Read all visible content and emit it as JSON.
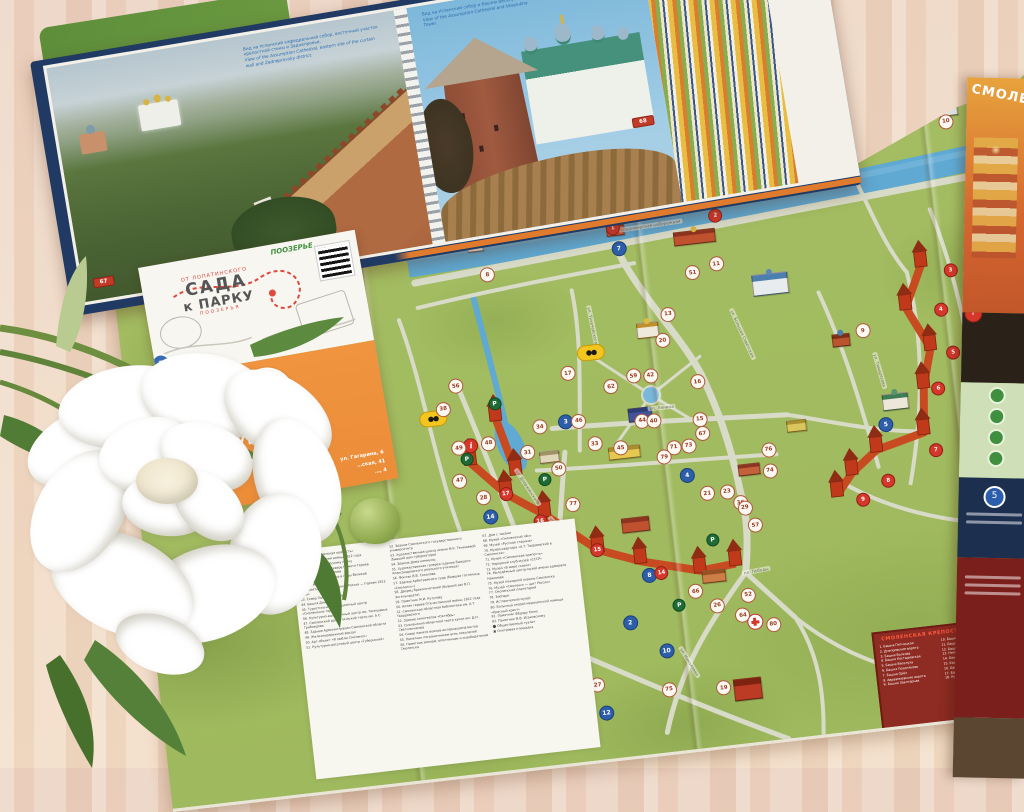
{
  "book": {
    "left_page": {
      "caption_ru": "Вид на Успенский кафедральный собор, восточный участок крепостной стены и Заднепровье.",
      "caption_en": "View of the Assumption Cathedral, eastern site of the curtain wall and Zadneprovsky district.",
      "page_number": "67"
    },
    "right_page": {
      "caption_ru": "Вид на Успенский собор и башню Веселуха.",
      "caption_en": "View of the Assumption Cathedral and Veselukha Tower.",
      "page_number": "68"
    }
  },
  "leaflet": {
    "header_small": "ОТ ЛОПАТИНСКОГО",
    "title_line1": "САДА",
    "title_line2": "к ПАРКУ",
    "subtitle": "ПООЗЕРЬЯ",
    "corner_text": "ПООЗЕРЬЕ",
    "badge": "3",
    "logo_text": "ФЫР-ФЫР",
    "shop_line1": "…ЫЕ СУВЕНИРЫ",
    "shop_line2": "СМОЛЕНСКА",
    "addresses": [
      "ул. Гагарина, 6",
      "…ская, 41",
      "…, 4"
    ]
  },
  "map": {
    "cover_title": "СМОЛЕНСК",
    "cover_badge": "5",
    "info_symbol": "i",
    "river_label": "Владимирская набережная",
    "streets": [
      {
        "label": "Владимирская набережная",
        "x": 54,
        "y": 17.5,
        "r": -2
      },
      {
        "label": "ул. Большая Советская",
        "x": 63,
        "y": 36,
        "r": 72
      },
      {
        "label": "ул. Ленина",
        "x": 55,
        "y": 46,
        "r": 1
      },
      {
        "label": "ул. Дзержинского",
        "x": 39,
        "y": 56,
        "r": 63
      },
      {
        "label": "ул. Тухачевского",
        "x": 48,
        "y": 32,
        "r": 85
      },
      {
        "label": "пл. Победы",
        "x": 63,
        "y": 73,
        "r": -4
      },
      {
        "label": "ул. Николаева",
        "x": 54.5,
        "y": 86,
        "r": 65
      },
      {
        "label": "ул. Тимирязева",
        "x": 78,
        "y": 44,
        "r": 80
      },
      {
        "label": "ул. Гагарина",
        "x": 42.5,
        "y": 63,
        "r": 55
      }
    ],
    "markers": [
      {
        "x": 39.7,
        "y": 22.7,
        "type": "w",
        "label": "8"
      },
      {
        "x": 53.9,
        "y": 20.9,
        "type": "b",
        "label": "7"
      },
      {
        "x": 64.0,
        "y": 25.0,
        "type": "w",
        "label": "11"
      },
      {
        "x": 61.4,
        "y": 26.0,
        "type": "w",
        "label": "51"
      },
      {
        "x": 78.7,
        "y": 38.0,
        "type": "w",
        "label": "9"
      },
      {
        "x": 90.0,
        "y": 7.0,
        "type": "w",
        "label": "10"
      },
      {
        "x": 58.3,
        "y": 32.0,
        "type": "w",
        "label": "13"
      },
      {
        "x": 57.4,
        "y": 36.0,
        "type": "w",
        "label": "20"
      },
      {
        "x": 47.0,
        "y": 39.4,
        "type": "w",
        "label": "17"
      },
      {
        "x": 49.7,
        "y": 36.6,
        "type": "v",
        "label": "●●"
      },
      {
        "x": 32.2,
        "y": 44.0,
        "type": "v",
        "label": "●●"
      },
      {
        "x": 35.0,
        "y": 39.4,
        "type": "w",
        "label": "56"
      },
      {
        "x": 33.4,
        "y": 42.8,
        "type": "w",
        "label": "38"
      },
      {
        "x": 35.9,
        "y": 48.9,
        "type": "i",
        "label": "i"
      },
      {
        "x": 34.6,
        "y": 49.1,
        "type": "w",
        "label": "49"
      },
      {
        "x": 37.8,
        "y": 48.9,
        "type": "w",
        "label": "48"
      },
      {
        "x": 34.3,
        "y": 54.2,
        "type": "w",
        "label": "47"
      },
      {
        "x": 36.6,
        "y": 57.2,
        "type": "w",
        "label": "28"
      },
      {
        "x": 46.2,
        "y": 46.9,
        "type": "b",
        "label": "3"
      },
      {
        "x": 47.6,
        "y": 47.0,
        "type": "w",
        "label": "46"
      },
      {
        "x": 43.4,
        "y": 47.2,
        "type": "w",
        "label": "34"
      },
      {
        "x": 41.8,
        "y": 51.0,
        "type": "w",
        "label": "31"
      },
      {
        "x": 44.9,
        "y": 54.0,
        "type": "w",
        "label": "50"
      },
      {
        "x": 53.9,
        "y": 41.0,
        "type": "w",
        "label": "59"
      },
      {
        "x": 55.7,
        "y": 41.2,
        "type": "w",
        "label": "42"
      },
      {
        "x": 60.6,
        "y": 43.0,
        "type": "w",
        "label": "16"
      },
      {
        "x": 51.4,
        "y": 42.2,
        "type": "w",
        "label": "62"
      },
      {
        "x": 60.4,
        "y": 48.9,
        "type": "w",
        "label": "15"
      },
      {
        "x": 60.5,
        "y": 51.1,
        "type": "w",
        "label": "67"
      },
      {
        "x": 49.0,
        "y": 50.8,
        "type": "w",
        "label": "33"
      },
      {
        "x": 51.7,
        "y": 51.9,
        "type": "w",
        "label": "45"
      },
      {
        "x": 54.3,
        "y": 48.1,
        "type": "w",
        "label": "44"
      },
      {
        "x": 55.5,
        "y": 48.3,
        "type": "w",
        "label": "40"
      },
      {
        "x": 57.3,
        "y": 52.8,
        "type": "w",
        "label": "71"
      },
      {
        "x": 58.9,
        "y": 52.8,
        "type": "w",
        "label": "73"
      },
      {
        "x": 56.2,
        "y": 54.1,
        "type": "w",
        "label": "79"
      },
      {
        "x": 63.8,
        "y": 81.3,
        "type": "x",
        "label": ""
      },
      {
        "x": 65.0,
        "y": 66.3,
        "type": "w",
        "label": "57"
      },
      {
        "x": 63.7,
        "y": 62.5,
        "type": "w",
        "label": "36"
      },
      {
        "x": 62.4,
        "y": 60.6,
        "type": "w",
        "label": "23"
      },
      {
        "x": 64.1,
        "y": 63.4,
        "type": "w",
        "label": "29"
      },
      {
        "x": 60.3,
        "y": 60.5,
        "type": "w",
        "label": "21"
      },
      {
        "x": 67.2,
        "y": 58.1,
        "type": "w",
        "label": "74"
      },
      {
        "x": 67.3,
        "y": 54.8,
        "type": "w",
        "label": "76"
      },
      {
        "x": 57.9,
        "y": 75.5,
        "type": "w",
        "label": "66"
      },
      {
        "x": 60.0,
        "y": 78.1,
        "type": "w",
        "label": "26"
      },
      {
        "x": 63.4,
        "y": 77.0,
        "type": "w",
        "label": "52"
      },
      {
        "x": 62.6,
        "y": 80.0,
        "type": "w",
        "label": "64"
      },
      {
        "x": 65.7,
        "y": 82.0,
        "type": "w",
        "label": "80"
      },
      {
        "x": 53.9,
        "y": 90.3,
        "type": "w",
        "label": "75"
      },
      {
        "x": 59.7,
        "y": 91.0,
        "type": "w",
        "label": "19"
      },
      {
        "x": 46.4,
        "y": 88.3,
        "type": "w",
        "label": "27"
      },
      {
        "x": 39.1,
        "y": 64.7,
        "type": "w",
        "label": "37"
      },
      {
        "x": 44.5,
        "y": 66.0,
        "type": "w",
        "label": "35"
      },
      {
        "x": 42.6,
        "y": 67.8,
        "type": "w",
        "label": "63"
      },
      {
        "x": 46.0,
        "y": 59.8,
        "type": "w",
        "label": "77"
      },
      {
        "x": 53.2,
        "y": 72.2,
        "type": "b",
        "label": "8"
      },
      {
        "x": 50.6,
        "y": 79.2,
        "type": "b",
        "label": "2"
      },
      {
        "x": 54.1,
        "y": 84.2,
        "type": "b",
        "label": "10"
      },
      {
        "x": 47.0,
        "y": 92.8,
        "type": "b",
        "label": "12"
      },
      {
        "x": 37.1,
        "y": 60.3,
        "type": "b",
        "label": "14"
      },
      {
        "x": 58.4,
        "y": 57.3,
        "type": "b",
        "label": "4"
      },
      {
        "x": 80.0,
        "y": 53.0,
        "type": "b",
        "label": "5"
      },
      {
        "x": 88.7,
        "y": 30.2,
        "type": "r",
        "label": "3"
      },
      {
        "x": 87.2,
        "y": 36.1,
        "type": "r",
        "label": "4"
      },
      {
        "x": 88.0,
        "y": 43.0,
        "type": "r",
        "label": "5"
      },
      {
        "x": 86.0,
        "y": 48.3,
        "type": "r",
        "label": "6"
      },
      {
        "x": 85.0,
        "y": 57.8,
        "type": "r",
        "label": "7"
      },
      {
        "x": 79.6,
        "y": 61.7,
        "type": "r",
        "label": "8"
      },
      {
        "x": 76.7,
        "y": 64.2,
        "type": "r",
        "label": "9"
      },
      {
        "x": 39.0,
        "y": 57.0,
        "type": "r",
        "label": "17"
      },
      {
        "x": 42.3,
        "y": 61.9,
        "type": "r",
        "label": "16"
      },
      {
        "x": 48.0,
        "y": 67.4,
        "type": "r",
        "label": "15"
      },
      {
        "x": 54.5,
        "y": 72.0,
        "type": "r",
        "label": "14"
      },
      {
        "x": 53.5,
        "y": 17.7,
        "type": "r",
        "label": "1"
      },
      {
        "x": 64.5,
        "y": 17.5,
        "type": "r",
        "label": "2"
      },
      {
        "x": 43.3,
        "y": 55.5,
        "type": "p",
        "label": "P"
      },
      {
        "x": 60.3,
        "y": 67.8,
        "type": "p",
        "label": "P"
      },
      {
        "x": 56.0,
        "y": 77.3,
        "type": "p",
        "label": "P"
      },
      {
        "x": 38.9,
        "y": 42.8,
        "type": "p",
        "label": "P"
      },
      {
        "x": 35.3,
        "y": 51.0,
        "type": "p",
        "label": "P"
      }
    ],
    "buildings": [
      {
        "x": 69.5,
        "y": 29.0,
        "w": 34,
        "h": 20,
        "body": "#e9ecef",
        "roof": "#4c7fae",
        "dome": "#5c88b4"
      },
      {
        "x": 90.0,
        "y": 5.0,
        "w": 24,
        "h": 13,
        "body": "#dfe3de",
        "roof": "#6a8d57",
        "dome": "#88a46a"
      },
      {
        "x": 53.7,
        "y": 17.8,
        "w": 16,
        "h": 12,
        "body": "#c8553a",
        "roof": "#8d3420",
        "dome": "#d8b341"
      },
      {
        "x": 62.0,
        "y": 20.5,
        "w": 40,
        "h": 12,
        "body": "#c0512f",
        "roof": "#8d3420",
        "dome": "#d8b341"
      },
      {
        "x": 38.7,
        "y": 18.0,
        "w": 14,
        "h": 10,
        "body": "#f0eee6",
        "roof": "#8a8f93",
        "dome": null
      },
      {
        "x": 56.0,
        "y": 34.0,
        "w": 20,
        "h": 14,
        "body": "#efe9db",
        "roof": "#bf8f2c",
        "dome": "#e2b93b"
      },
      {
        "x": 54.1,
        "y": 47.0,
        "w": 22,
        "h": 12,
        "body": "#40549c",
        "roof": "#2c3c74",
        "dome": null
      },
      {
        "x": 52.0,
        "y": 52.6,
        "w": 30,
        "h": 11,
        "body": "#e5c84f",
        "roof": "#a98f2d",
        "dome": null
      },
      {
        "x": 52.3,
        "y": 64.0,
        "w": 26,
        "h": 13,
        "body": "#c0512f",
        "roof": "#8d3420",
        "dome": null
      },
      {
        "x": 81.3,
        "y": 49.5,
        "w": 24,
        "h": 15,
        "body": "#ece7d8",
        "roof": "#3f7d57",
        "dome": "#56946b"
      },
      {
        "x": 76.3,
        "y": 39.0,
        "w": 16,
        "h": 11,
        "body": "#b9542f",
        "roof": "#7e2d18",
        "dome": "#4c7fae"
      },
      {
        "x": 62.2,
        "y": 91.5,
        "w": 26,
        "h": 20,
        "body": "#bb3b24",
        "roof": "#7e2212",
        "dome": null
      },
      {
        "x": 65.0,
        "y": 57.5,
        "w": 20,
        "h": 10,
        "body": "#c4603a",
        "roof": "#8d3420",
        "dome": null
      },
      {
        "x": 60.0,
        "y": 73.5,
        "w": 22,
        "h": 11,
        "body": "#cd7d46",
        "roof": "#95511f",
        "dome": null
      },
      {
        "x": 44.0,
        "y": 52.0,
        "w": 18,
        "h": 10,
        "body": "#e0d6b8",
        "roof": "#a09264",
        "dome": null
      },
      {
        "x": 70.5,
        "y": 51.5,
        "w": 18,
        "h": 10,
        "body": "#d9c75e",
        "roof": "#a98f2d",
        "dome": null
      }
    ],
    "legend": {
      "columns": [
        [
          "36. Музей «Смоленская крепость»",
          "37. Памятник Героям войны 1812 года",
          "38. Памятник Софийскому полку",
          "39. Вечный огонь в Сквере Памяти Героев",
          "40. Аллея городов-героев",
          "41. Музей «Смоленщина в годы Великой Отечественной войны»",
          "42. Памятник «Благодарная Россия — Героям 1812 года»",
          "43. Сквер Памяти Героев",
          "44. Башня Донец",
          "45. Туристско-информационный центр «Смоленские терема»",
          "46. Культурно-выставочный центр им. Тенишевых",
          "47. Смоленский драматический театр им. А.С. Грибоедова",
          "48. Здание Администрации Смоленской области",
          "49. Железнодорожный вокзал",
          "50. Арт-объект «Я люблю Смоленск»",
          "51. Культурно-досуговый центр «Губернский»"
        ],
        [
          "52. Здание Смоленского государственного университета",
          "53. Художественная школа имени М.К. Тенишевой (бывший дом губернатора)",
          "54. Здание Дома-коммуны",
          "55. Художественная галерея (здание бывшего Александровского реального училища)",
          "56. Фонтан В.В. Соколова",
          "57. Здание Арбитражного суда (бывшая гостиница «Смоленск»)",
          "58. Дворец бракосочетаний (бывший зал В.П. Энгельгардта)",
          "59. Памятник М.И. Кутузову",
          "60. Аллея героев Отечественной войны 1812 года",
          "61. Смоленская областная библиотека им. А.Т. Твардовского",
          "62. Здание кинотеатра «Октябрь»",
          "63. Смоленский областной театр кукол им. Д.Н. Светильникова",
          "64. Сквер памяти воинов-интернационалистов",
          "65. Памятник пограничникам всех поколений",
          "66. Памятник воинам, ополченцам и освободителям Смоленска"
        ],
        [
          "67. Дом с часами",
          "68. Музей «Смоленский лён»",
          "69. Музей «Русская старина»",
          "70. Музей-квартира «А.Т. Твардовский в Смоленске»",
          "71. Музей «Смоленская крепость»",
          "72. Народный клуб-музей «СССР»",
          "73. Музей «В мире сказки»",
          "74. Молодёжный центр-музей имени адмирала Нахимова",
          "75. Музей пожарной охраны Смоленска",
          "76. Музей «Смоленск — щит России»",
          "77. Смоленский планетарий",
          "78. Зоопарк",
          "79. Исторический музей",
          "80. Больница скорой медицинской помощи «Красный крест»",
          "81. Памятник Фёдору Коню",
          "82. Памятник М.В. Исаковскому",
          "⬤ Общественный туалет",
          "▣ Смотровая площадка"
        ]
      ]
    },
    "wall_legend": {
      "title": "СМОЛЕНСКАЯ КРЕПОСТНАЯ СТЕНА",
      "items": [
        "1. Башня Пятницкая",
        "2. Днепровские ворота",
        "3. Башня Волкова",
        "4. Башня Костыревская",
        "5. Башня Веселуха",
        "6. Башня Позднякова",
        "7. Башня Орёл",
        "8. Авраамиевские ворота",
        "9. Башня Заалтарная",
        "10. Башня Воронина",
        "11. Башня Долгочевская",
        "12. Башня Зимбулка",
        "13. Никольские ворота",
        "14. Башня Моховая",
        "15. Башня Донец",
        "16. Башня Громовая",
        "17. Башня Бублейка",
        "18. Копытенские ворота"
      ]
    },
    "wall": {
      "west": [
        [
          365,
          289
        ],
        [
          379,
          345
        ]
      ],
      "south": [
        [
          335,
          330
        ],
        [
          367,
          365
        ],
        [
          403,
          390
        ],
        [
          452,
          431
        ],
        [
          493,
          447
        ],
        [
          551,
          463
        ],
        [
          587,
          460
        ]
      ],
      "east": [
        [
          805,
          184
        ],
        [
          785,
          225
        ],
        [
          805,
          268
        ],
        [
          794,
          305
        ],
        [
          789,
          351
        ],
        [
          740,
          363
        ],
        [
          713,
          383
        ],
        [
          696,
          403
        ]
      ]
    }
  }
}
